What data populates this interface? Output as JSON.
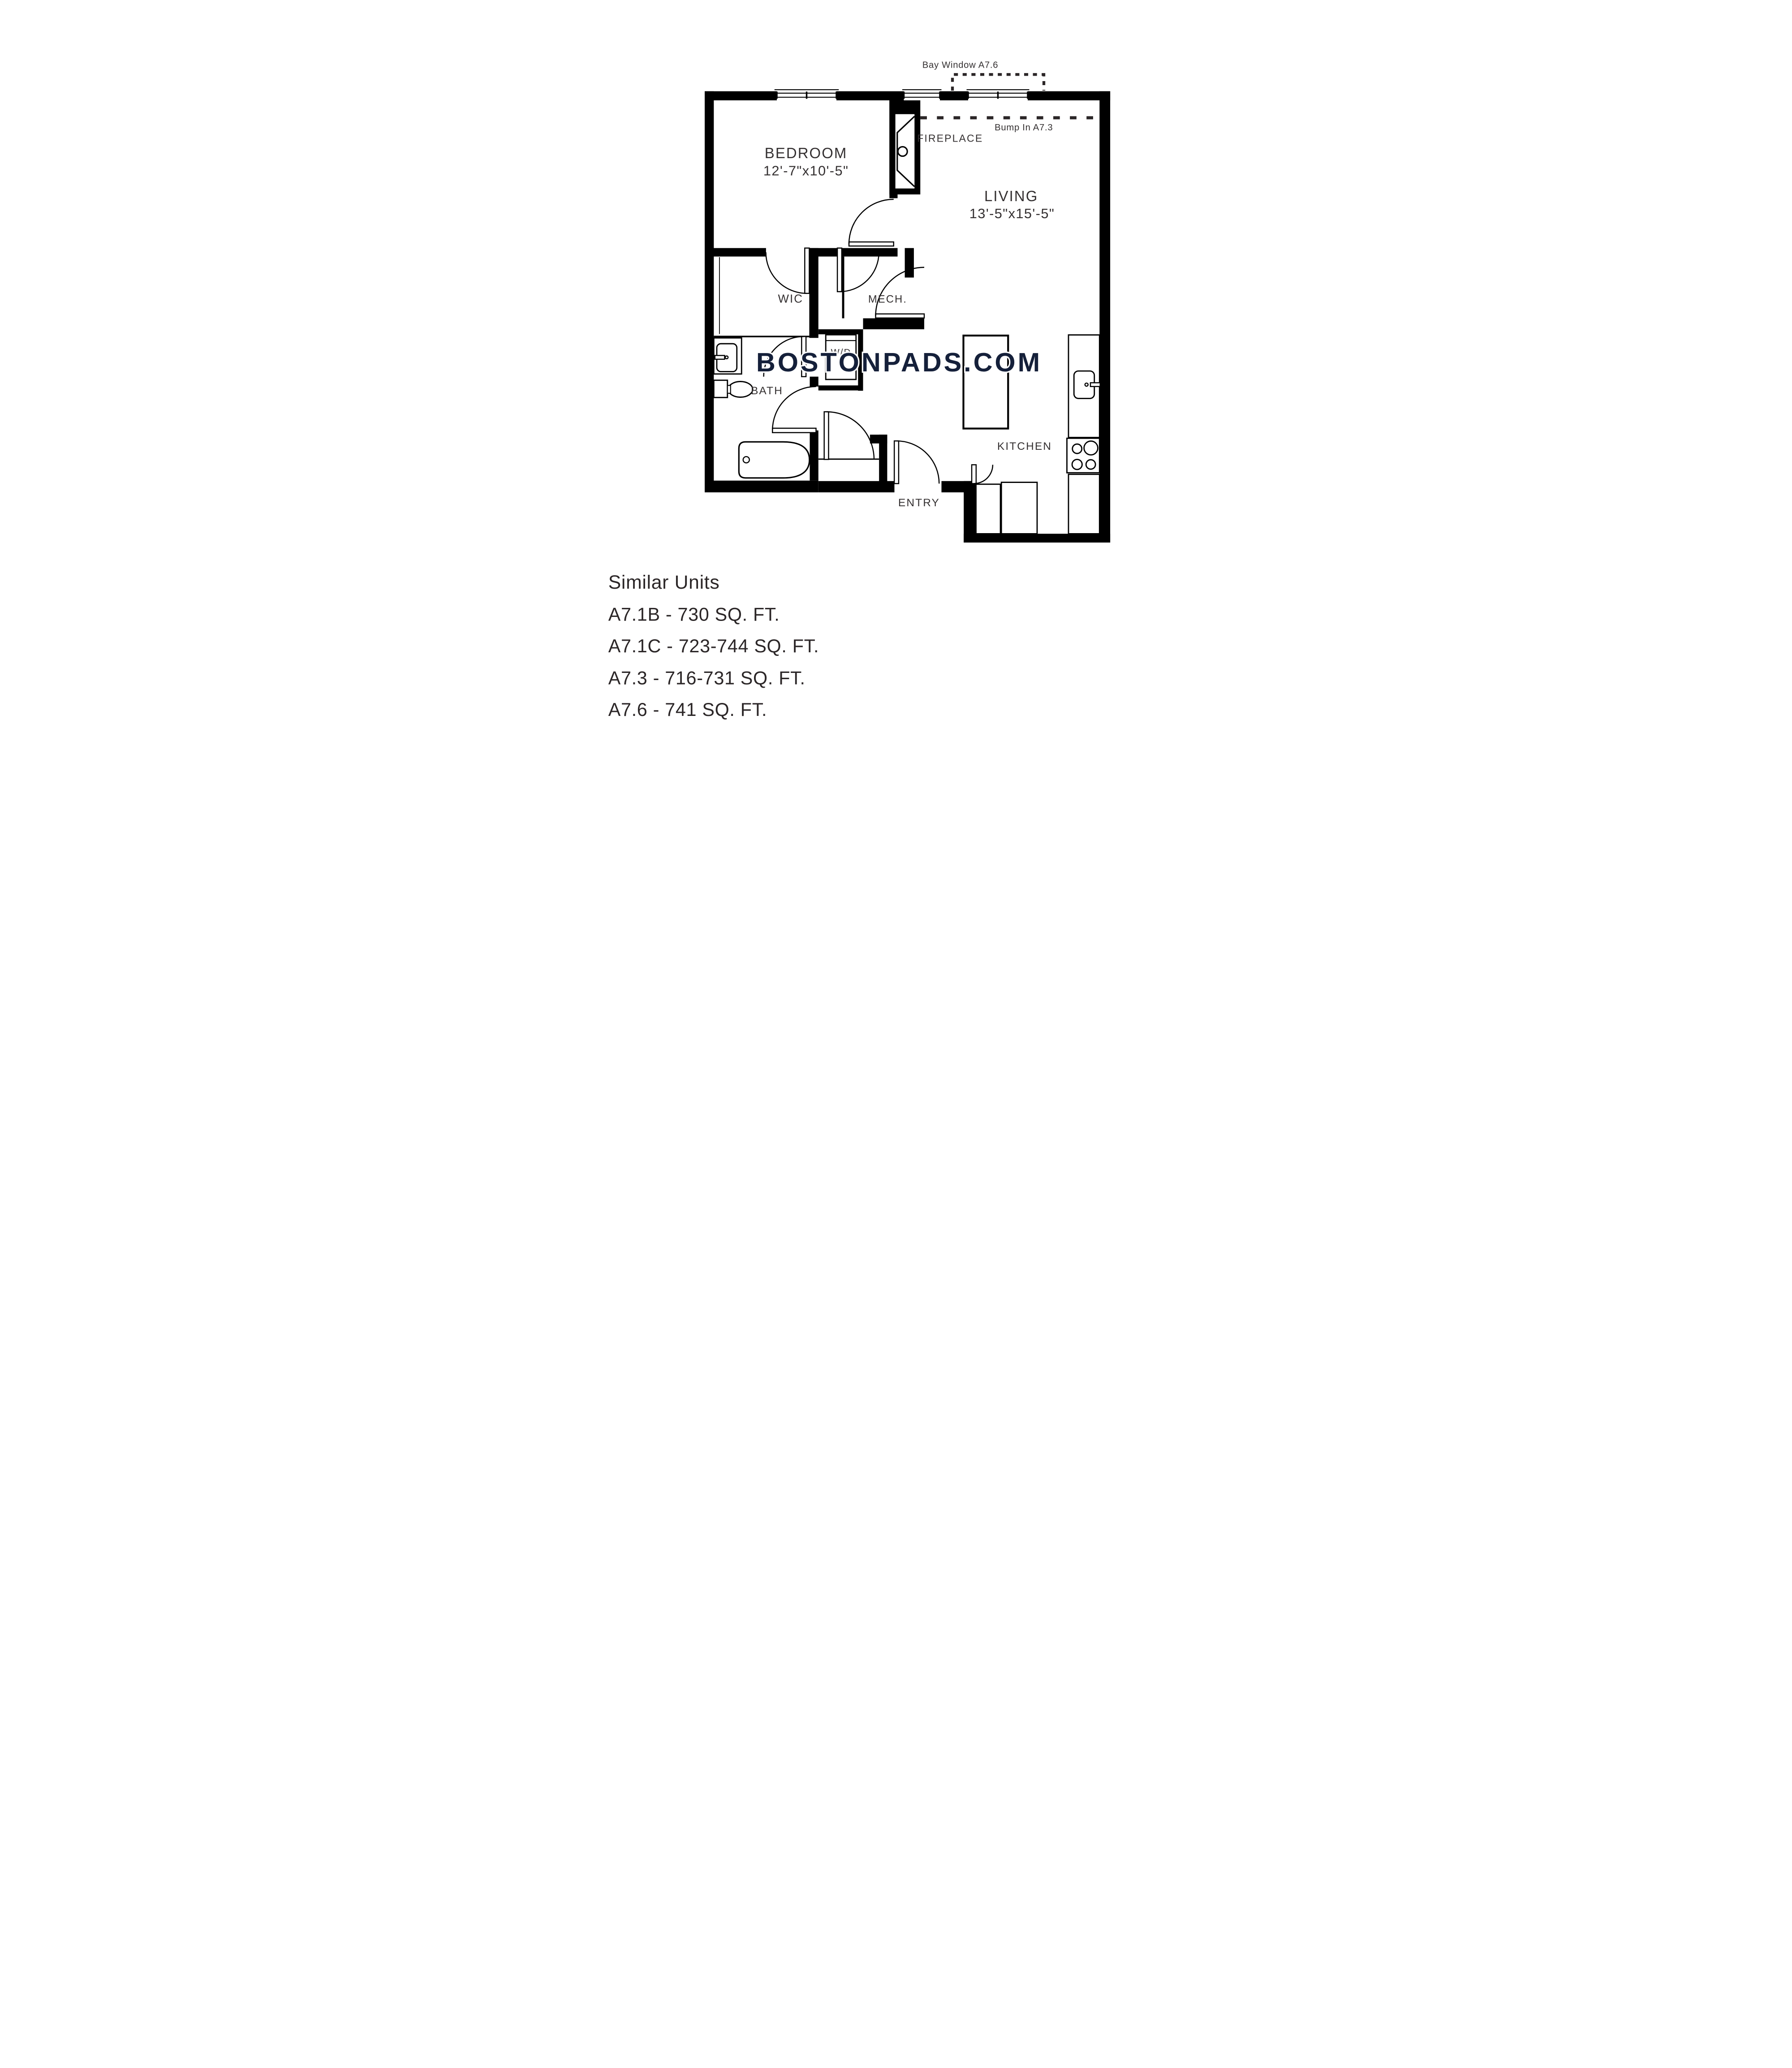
{
  "plan": {
    "labels": {
      "bay_window": "Bay Window A7.6",
      "bump_in": "Bump In A7.3",
      "fireplace": "FIREPLACE",
      "bedroom": "BEDROOM",
      "bedroom_dims": "12'-7\"x10'-5\"",
      "living": "LIVING",
      "living_dims": "13'-5\"x15'-5\"",
      "wic": "WIC",
      "mech": "MECH.",
      "wd": "W/D",
      "bath": "BATH",
      "kitchen": "KITCHEN",
      "entry": "ENTRY"
    },
    "watermark": {
      "text": "BOSTONPADS.COM",
      "color": "#15203a"
    },
    "wall_color": "#000000",
    "label_color": "#343031"
  },
  "similar_units": {
    "heading": "Similar Units",
    "units": [
      "A7.1B - 730 SQ. FT.",
      "A7.1C - 723-744 SQ. FT.",
      "A7.3 - 716-731 SQ. FT.",
      "A7.6 - 741 SQ. FT."
    ]
  }
}
